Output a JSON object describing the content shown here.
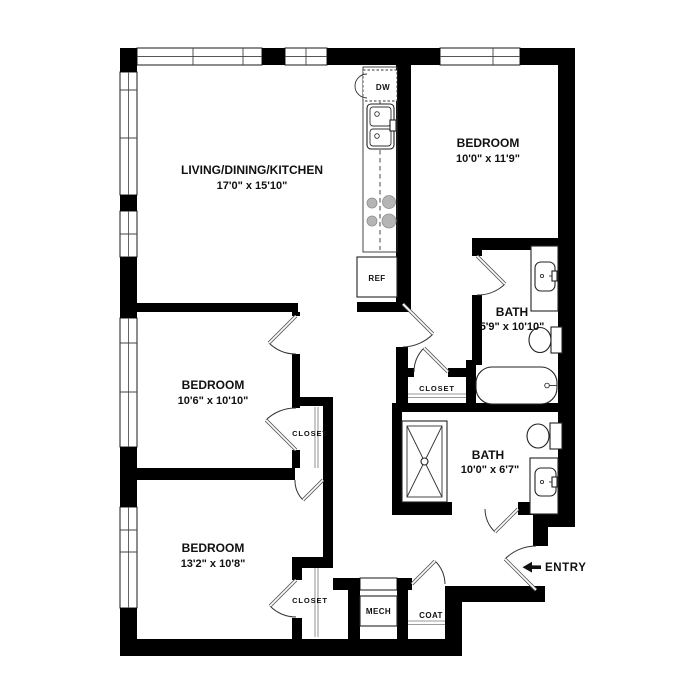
{
  "plan": {
    "type": "apartment-floor-plan",
    "rooms": [
      {
        "id": "living-dining-kitchen",
        "name": "LIVING/DINING/KITCHEN",
        "dims": "17'0\" x 15'10\""
      },
      {
        "id": "bedroom-top-right",
        "name": "BEDROOM",
        "dims": "10'0\" x 11'9\""
      },
      {
        "id": "bedroom-middle-left",
        "name": "BEDROOM",
        "dims": "10'6\" x 10'10\""
      },
      {
        "id": "bedroom-bottom-left",
        "name": "BEDROOM",
        "dims": "13'2\" x 10'8\""
      },
      {
        "id": "bath-upper",
        "name": "BATH",
        "dims": "5'9\" x 10'10\""
      },
      {
        "id": "bath-lower",
        "name": "BATH",
        "dims": "10'0\" x 6'7\""
      }
    ],
    "labels": {
      "closet_middle_bedroom": "CLOSET",
      "closet_hall": "CLOSET",
      "closet_bottom_bedroom": "CLOSET",
      "mech": "MECH",
      "coat": "COAT",
      "dishwasher": "DW",
      "refrigerator": "REF",
      "entry": "ENTRY"
    },
    "colors": {
      "wall": "#000000",
      "background": "#ffffff",
      "appliance_gray": "#b5b5b5",
      "rod_gray": "#9a9a9a"
    }
  }
}
